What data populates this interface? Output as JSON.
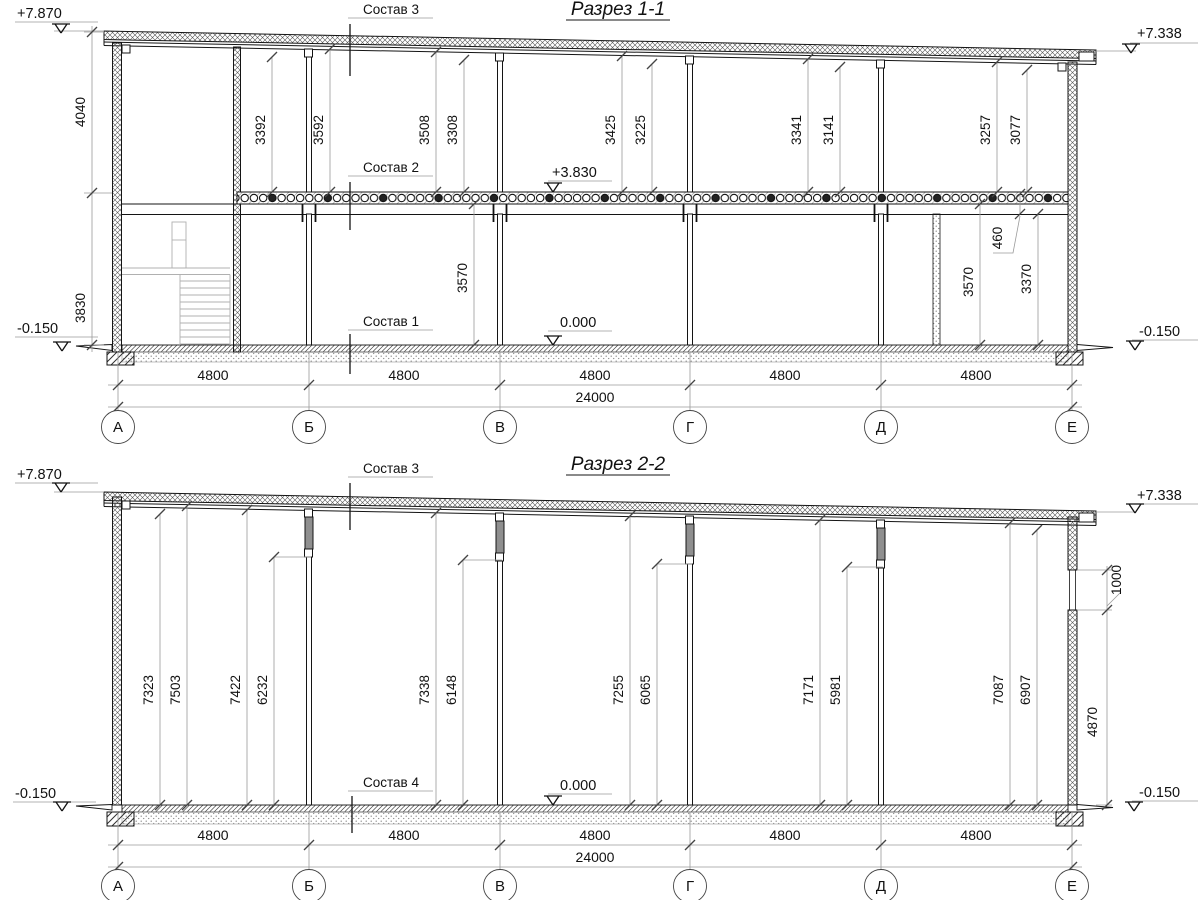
{
  "drawing": {
    "axes": [
      "А",
      "Б",
      "В",
      "Г",
      "Д",
      "Е"
    ],
    "s1": {
      "title": "Разрез 1-1",
      "layers": {
        "l1": "Состав 1",
        "l2": "Состав 2",
        "l3": "Состав 3"
      },
      "elev": {
        "tl": "+7.870",
        "tr": "+7.338",
        "bl": "-0.150",
        "br": "-0.150",
        "slab": "+3.830",
        "floor": "0.000"
      },
      "left": [
        "4040",
        "3830"
      ],
      "bays": [
        "3392",
        "3592",
        "3508",
        "3308",
        "3425",
        "3225",
        "3341",
        "3141",
        "3257",
        "3077"
      ],
      "floor_dims": [
        "3570",
        "3570",
        "460",
        "3370"
      ],
      "spans": [
        "4800",
        "4800",
        "4800",
        "4800",
        "4800"
      ],
      "total": "24000"
    },
    "s2": {
      "title": "Разрез 2-2",
      "layers": {
        "l3": "Состав 3",
        "l4": "Состав 4"
      },
      "elev": {
        "tl": "+7.870",
        "tr": "+7.338",
        "bl": "-0.150",
        "br": "-0.150",
        "floor": "0.000"
      },
      "bays": [
        "7323",
        "7503",
        "7422",
        "6232",
        "7338",
        "6148",
        "7255",
        "6065",
        "7171",
        "5981",
        "7087",
        "6907"
      ],
      "right": [
        "1000",
        "4870"
      ],
      "spans": [
        "4800",
        "4800",
        "4800",
        "4800",
        "4800"
      ],
      "total": "24000"
    }
  }
}
